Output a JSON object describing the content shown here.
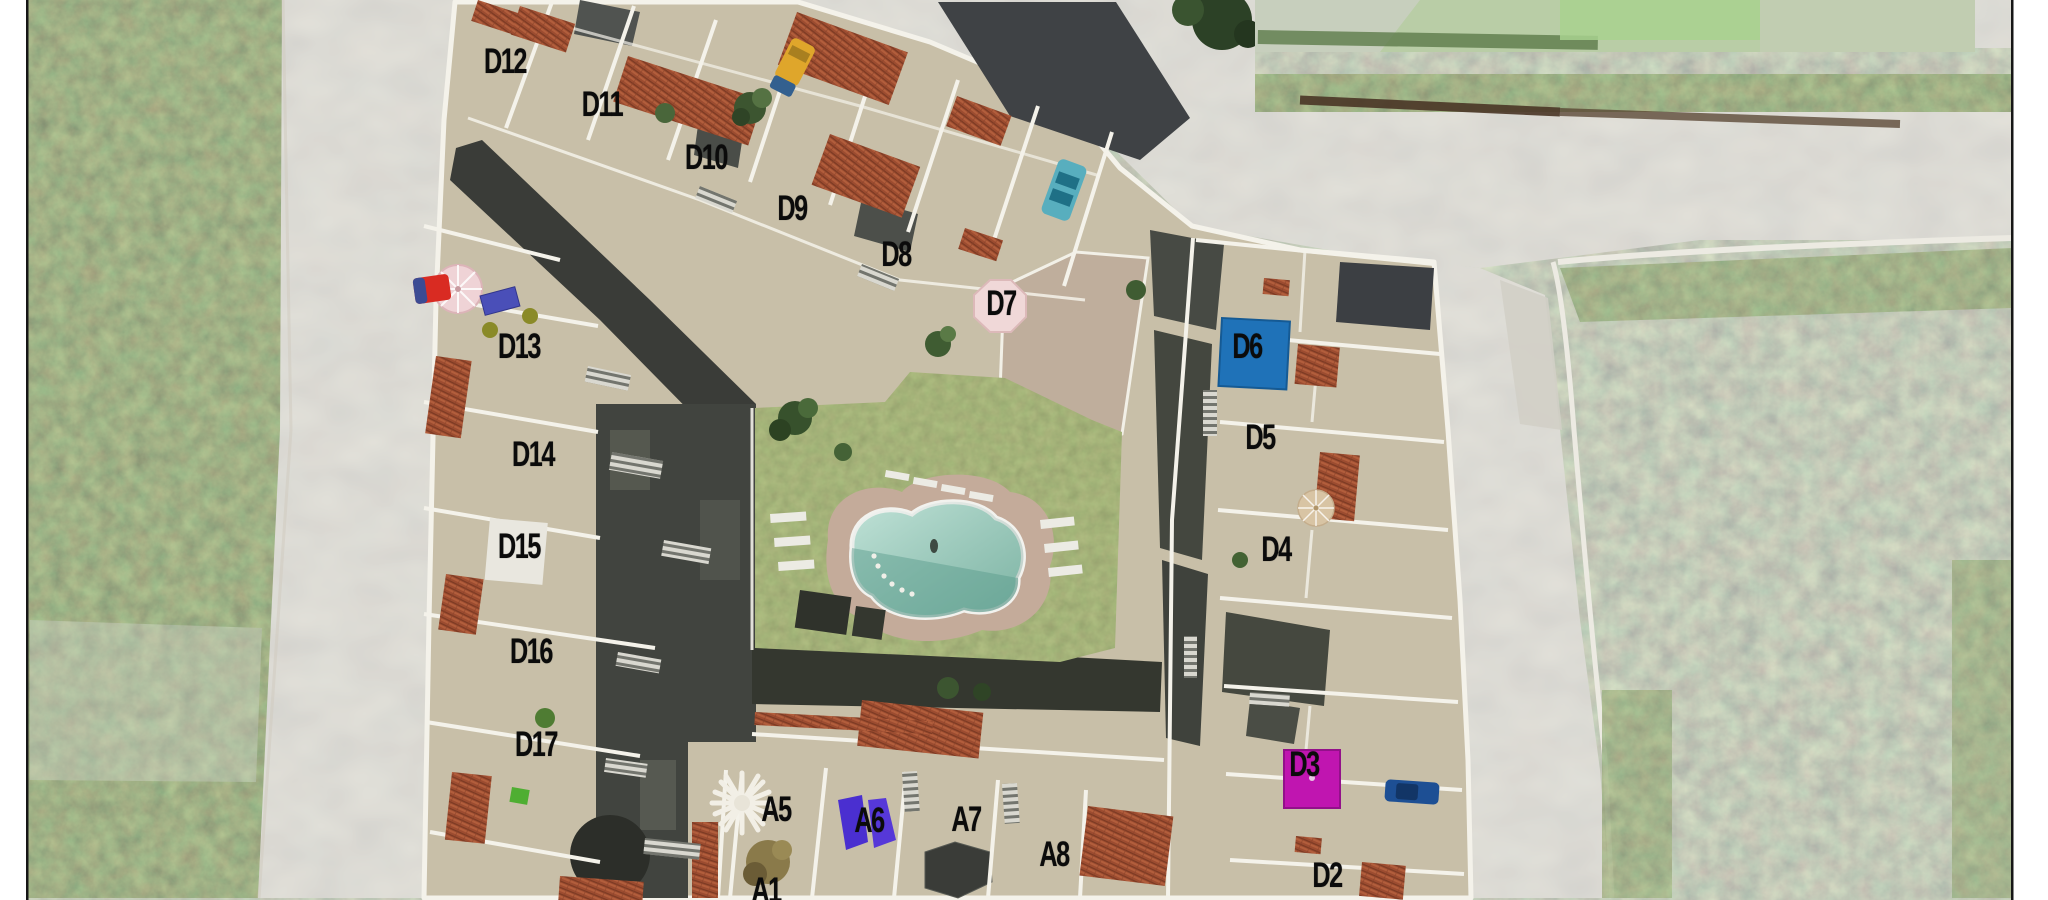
{
  "frame": {
    "margin_color": "#ffffff",
    "border_color": "#161616"
  },
  "site_plan": {
    "description_units_note": "unit plot labels visible on the masterplan",
    "units": [
      {
        "id": "D12",
        "x": 505,
        "y": 64
      },
      {
        "id": "D11",
        "x": 602,
        "y": 107
      },
      {
        "id": "D10",
        "x": 706,
        "y": 160
      },
      {
        "id": "D9",
        "x": 792,
        "y": 211
      },
      {
        "id": "D8",
        "x": 896,
        "y": 257
      },
      {
        "id": "D7",
        "x": 1001,
        "y": 306
      },
      {
        "id": "D6",
        "x": 1247,
        "y": 349
      },
      {
        "id": "D5",
        "x": 1260,
        "y": 440
      },
      {
        "id": "D4",
        "x": 1276,
        "y": 552
      },
      {
        "id": "D3",
        "x": 1304,
        "y": 767
      },
      {
        "id": "D2",
        "x": 1327,
        "y": 878
      },
      {
        "id": "D13",
        "x": 519,
        "y": 349
      },
      {
        "id": "D14",
        "x": 533,
        "y": 457
      },
      {
        "id": "D15",
        "x": 519,
        "y": 549
      },
      {
        "id": "D16",
        "x": 531,
        "y": 654
      },
      {
        "id": "D17",
        "x": 536,
        "y": 747
      },
      {
        "id": "A5",
        "x": 776,
        "y": 812
      },
      {
        "id": "A6",
        "x": 869,
        "y": 823
      },
      {
        "id": "A7",
        "x": 966,
        "y": 822
      },
      {
        "id": "A8",
        "x": 1054,
        "y": 857
      },
      {
        "id": "A1",
        "x": 766,
        "y": 893
      }
    ],
    "unit_label_color": "#0b0b0b",
    "complex": {
      "terrace_color": "#c8bfa8",
      "wall_color": "#f4f2ea"
    },
    "highlights": {
      "d6": {
        "unit": "D6",
        "color": "#1f72b8"
      },
      "d3": {
        "unit": "D3",
        "color": "#c015b0"
      },
      "a6": {
        "unit": "A6",
        "color": "#4a2fd0"
      },
      "d7_gazebo": {
        "unit": "D7",
        "color": "#f0d8d8"
      },
      "a5_palapa": {
        "unit": "A5",
        "color": "#f2efe6"
      }
    },
    "amenities": {
      "pool": {
        "water_color": "#9fd3c2",
        "deck_color": "#c4ab9a",
        "rim_color": "#f2f2ee"
      },
      "lawn_color": "#6d7c40"
    },
    "vehicles": [
      {
        "name": "yellow-car",
        "color": "#dfa62b"
      },
      {
        "name": "teal-car",
        "color": "#58aebe"
      },
      {
        "name": "red-car",
        "color": "#d92b22"
      },
      {
        "name": "blue-car",
        "color": "#1d4f94"
      }
    ],
    "umbrellas": [
      {
        "name": "pink-umbrella",
        "color": "#efd3d6"
      },
      {
        "name": "tan-umbrella",
        "color": "#d8c4a4"
      }
    ]
  }
}
